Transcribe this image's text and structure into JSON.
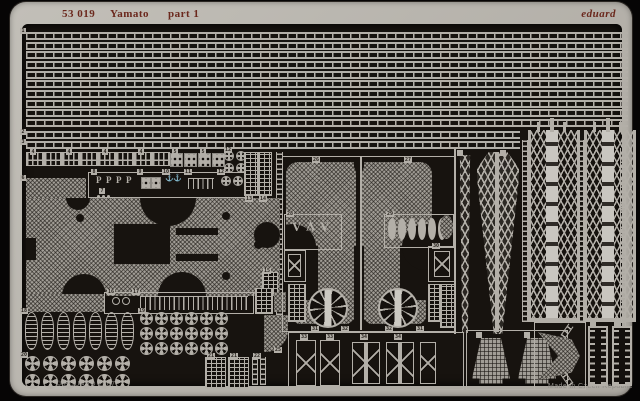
{
  "header": {
    "catalog": "53 019",
    "product": "Yamato",
    "part": "part 1",
    "brand": "eduard"
  },
  "footer": {
    "copyright": "© EDUARD 2007",
    "made_in": "Made in Czech Republic"
  },
  "part_labels": {
    "t1": "1",
    "t2": "2",
    "t3": "3",
    "t4": "4",
    "t5": "5",
    "t6": "6",
    "t7": "7",
    "t8": "8",
    "t9": "9",
    "t10": "10",
    "t11": "11",
    "t12": "12",
    "t13": "13",
    "t14": "14",
    "t15": "15",
    "t16": "16",
    "t17": "17",
    "t18": "18",
    "t19": "19",
    "t20": "20",
    "t21": "21",
    "t22": "22",
    "t25": "25",
    "t26": "26",
    "t27": "27",
    "t28": "28",
    "t29": "29",
    "t30": "30",
    "t31": "31",
    "t32": "32",
    "t33": "33",
    "t34": "34"
  },
  "colors": {
    "brass": "#b3afa8",
    "interior": "#17130f",
    "background": "#060505",
    "header_text": "#6b281d",
    "footer_text": "#8f8c87"
  },
  "parts_key": [
    {
      "num": "1-3",
      "name": "long railing strips"
    },
    {
      "num": "4",
      "name": "railing segments"
    },
    {
      "num": "5",
      "name": "perforated plates"
    },
    {
      "num": "6",
      "name": "deck platform"
    },
    {
      "num": "8",
      "name": "davits"
    },
    {
      "num": "10",
      "name": "anchors"
    },
    {
      "num": "12, 19, 20",
      "name": "cable reels"
    },
    {
      "num": "13-15",
      "name": "vent panels"
    },
    {
      "num": "17",
      "name": "stanchion row"
    },
    {
      "num": "18",
      "name": "float baskets"
    },
    {
      "num": "21-22",
      "name": "hatch grilles"
    },
    {
      "num": "25",
      "name": "curved platform"
    },
    {
      "num": "26-27",
      "name": "funnel grilles"
    },
    {
      "num": "28-30",
      "name": "small supports"
    },
    {
      "num": "31",
      "name": "vent grilles"
    },
    {
      "num": "32",
      "name": "funnel cap discs"
    },
    {
      "num": "33-34",
      "name": "yardarm supports"
    }
  ]
}
